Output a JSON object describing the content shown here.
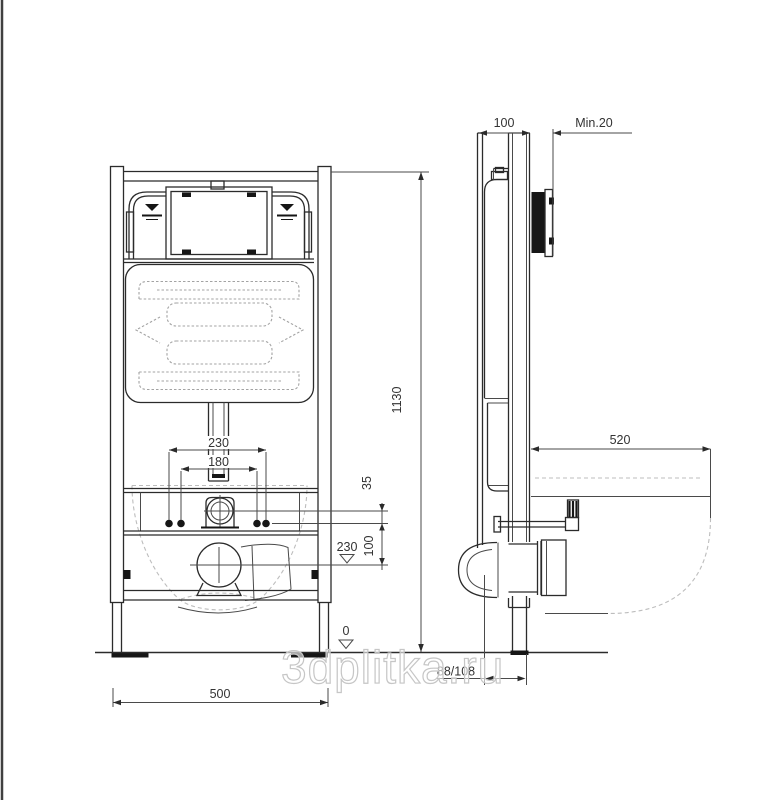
{
  "watermark": {
    "text": "3dplitka.ru"
  },
  "colors": {
    "line": "#2b2b2b",
    "hidden_line": "#bdbdbd",
    "label": "#333333",
    "background": "#ffffff"
  },
  "dimensions": {
    "frame_height": "1130",
    "frame_width": "500",
    "flush_pipe_width": "230",
    "bolt_spacing": "180",
    "inlet_above_bolts": "35",
    "bolts_above_outlet": "100",
    "outlet_level": "230",
    "floor_level": "0",
    "frame_depth": "100",
    "wall_clearance": "Min.20",
    "bowl_projection": "520",
    "outlet_offset": "88/108"
  }
}
